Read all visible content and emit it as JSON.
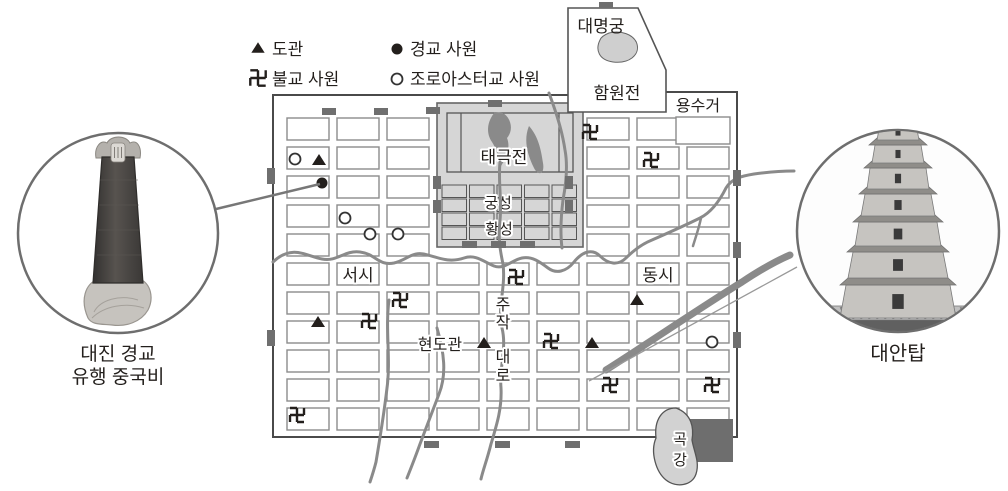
{
  "figure_title": "당 장안성 종교 사원 분포 지도",
  "legend": {
    "items": [
      {
        "symbol": "taoist-triangle",
        "label": "도관"
      },
      {
        "symbol": "nestorian-dot",
        "label": "경교 사원"
      },
      {
        "symbol": "buddhist-swastika",
        "label": "불교 사원"
      },
      {
        "symbol": "zoroastrian-circle",
        "label": "조로아스터교 사원"
      }
    ]
  },
  "map": {
    "daemyeonggung": "대명궁",
    "hamwonjeon": "함원전",
    "yongsugeo": "용수거",
    "taegukjeon": "태극전",
    "gungseong": "궁성",
    "hwangseong": "황성",
    "labels": [
      {
        "text": "서시",
        "x": 358,
        "y": 281,
        "size": 17,
        "vertical": false
      },
      {
        "text": "동시",
        "x": 658,
        "y": 281,
        "size": 17,
        "vertical": false
      },
      {
        "text": "현도관",
        "x": 440,
        "y": 350,
        "size": 16,
        "vertical": false
      },
      {
        "text": "주작대로",
        "x": 503,
        "y": 310,
        "size": 16,
        "vertical": true
      },
      {
        "text": "곡강",
        "x": 680,
        "y": 444,
        "size": 15,
        "vertical": true
      }
    ],
    "symbols": [
      {
        "type": "zoroastrian-circle",
        "x": 295,
        "y": 159
      },
      {
        "type": "taoist-triangle",
        "x": 319,
        "y": 160
      },
      {
        "type": "nestorian-dot",
        "x": 322,
        "y": 183
      },
      {
        "type": "zoroastrian-circle",
        "x": 345,
        "y": 218
      },
      {
        "type": "zoroastrian-circle",
        "x": 370,
        "y": 234
      },
      {
        "type": "zoroastrian-circle",
        "x": 398,
        "y": 234
      },
      {
        "type": "zoroastrian-circle",
        "x": 712,
        "y": 342
      },
      {
        "type": "taoist-triangle",
        "x": 318,
        "y": 322
      },
      {
        "type": "taoist-triangle",
        "x": 484,
        "y": 343
      },
      {
        "type": "taoist-triangle",
        "x": 592,
        "y": 343
      },
      {
        "type": "taoist-triangle",
        "x": 637,
        "y": 300
      },
      {
        "type": "buddhist-swastika",
        "x": 400,
        "y": 300
      },
      {
        "type": "buddhist-swastika",
        "x": 369,
        "y": 321
      },
      {
        "type": "buddhist-swastika",
        "x": 516,
        "y": 277
      },
      {
        "type": "buddhist-swastika",
        "x": 551,
        "y": 341
      },
      {
        "type": "buddhist-swastika",
        "x": 590,
        "y": 132
      },
      {
        "type": "buddhist-swastika",
        "x": 651,
        "y": 160
      },
      {
        "type": "buddhist-swastika",
        "x": 610,
        "y": 385
      },
      {
        "type": "buddhist-swastika",
        "x": 712,
        "y": 385
      },
      {
        "type": "buddhist-swastika",
        "x": 297,
        "y": 415
      }
    ]
  },
  "callouts": {
    "left": {
      "line1": "대진 경교",
      "line2": "유행 중국비"
    },
    "right": {
      "caption": "대안탑"
    }
  },
  "colors": {
    "ink": "#231f1c",
    "stream": "#8a8a8a",
    "gray_fill": "#d6d6d6",
    "gate": "#6f6f6f",
    "block_stroke": "#8c8c8c",
    "border": "#4a4a4a",
    "circle_stroke": "#6e6e6e",
    "dark_rect": "#6e6e6e",
    "gokgang_fill": "#d2d2d2"
  }
}
